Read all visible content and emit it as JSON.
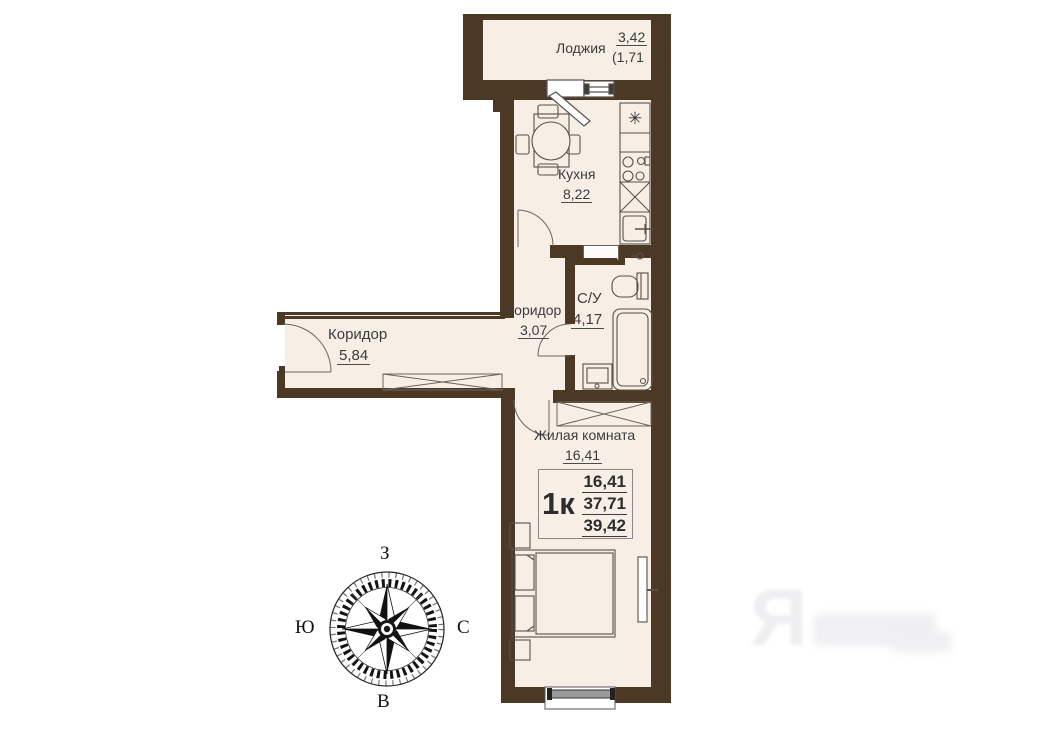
{
  "plan": {
    "rooms": [
      {
        "id": "loggia",
        "label": "Лоджия",
        "area": "3,42",
        "area_sub": "(1,71"
      },
      {
        "id": "kitchen",
        "label": "Кухня",
        "area": "8,22"
      },
      {
        "id": "bathroom",
        "label": "С/У",
        "area": "4,17"
      },
      {
        "id": "corridor-small",
        "label": "Коридор",
        "area": "3,07"
      },
      {
        "id": "corridor-main",
        "label": "Коридор",
        "area": "5,84"
      },
      {
        "id": "living-room",
        "label": "Жилая комната",
        "area": "16,41"
      }
    ],
    "info_box": {
      "type_label": "1к",
      "living_area": "16,41",
      "area_without_loggia": "37,71",
      "total_area": "39,42"
    },
    "compass": {
      "top": "З",
      "left": "Ю",
      "right": "С",
      "bottom": "В"
    },
    "watermark": {
      "letter": "Я"
    },
    "colors": {
      "wall": "#4b3926",
      "floor": "#f7efe6",
      "line": "#57524b",
      "text": "#3b3b3b"
    }
  }
}
